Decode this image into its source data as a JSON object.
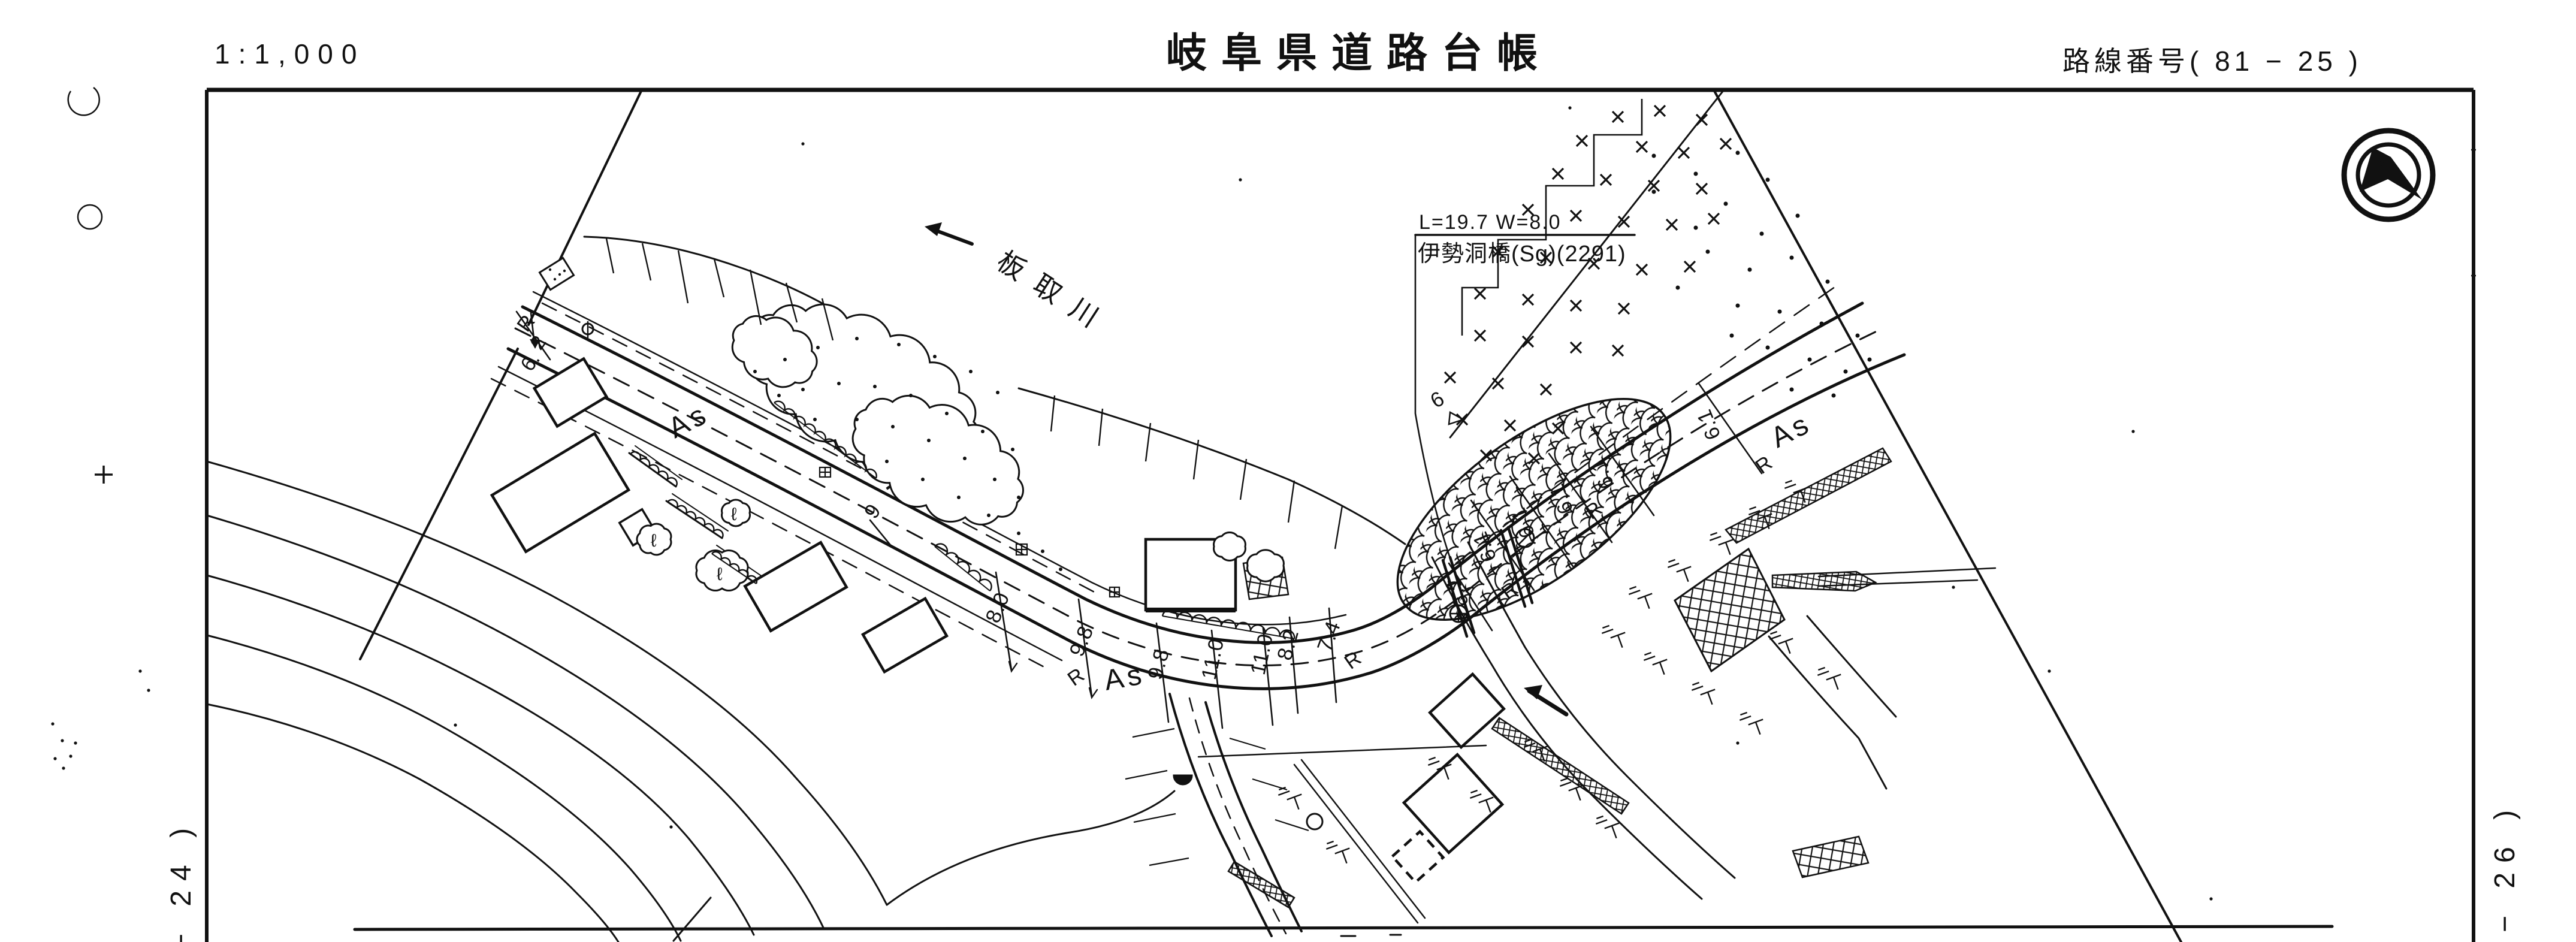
{
  "sheet": {
    "scale_label": "1:1,000",
    "title": "岐阜県道路台帳",
    "route_label": "路線番号( 81 − 25 )",
    "left_adjacent_sheet": "− 24 )",
    "right_adjacent_sheet": "− 26 )"
  },
  "map": {
    "river_name": "板取川",
    "bridge": {
      "dimensions": "L=19.7 W=8.0",
      "name": "伊勢洞橋(Sg)(2291)"
    },
    "surface_labels": {
      "as_left": "As",
      "as_center": "As",
      "as_right": "As"
    },
    "width_measurements": {
      "sag": [
        "8.0",
        "9.8",
        "9.8",
        "11.0",
        "11.0",
        "8.2",
        "7.4"
      ],
      "right": [
        "6.1",
        "6.1",
        "6.1",
        "6.1",
        "6.1",
        "6.1"
      ],
      "left_station": [
        "R",
        "2",
        "6."
      ],
      "single": "9",
      "bench": "6"
    },
    "wall_labels": [
      "R",
      "R",
      "R",
      "R",
      "R"
    ],
    "tree_symbol": "ℓ",
    "colors": {
      "ink": "#111111",
      "paper": "#ffffff"
    }
  },
  "icons": {
    "compass": "north-arrow"
  }
}
